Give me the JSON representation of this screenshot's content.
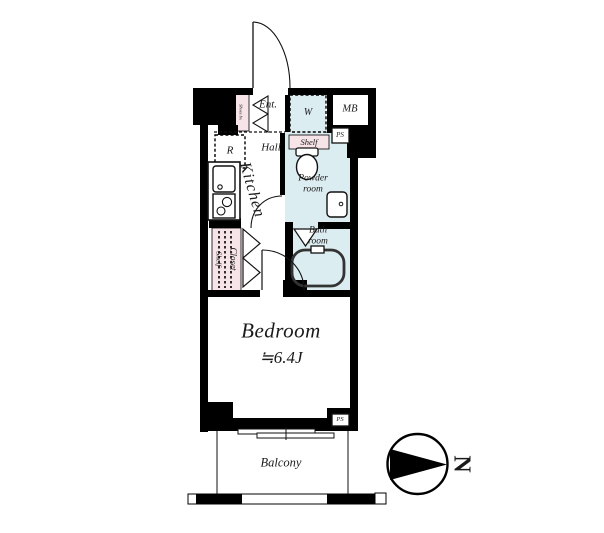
{
  "floorplan": {
    "rooms": {
      "entrance": "Ent.",
      "hall": "Hall",
      "kitchen": "Kitchen",
      "powder_room": "Powder room",
      "bath_room": "Bath room",
      "bedroom": "Bedroom",
      "bedroom_size": "≒6.4J",
      "balcony": "Balcony"
    },
    "fixtures": {
      "washer": "W",
      "meter_box": "MB",
      "pipe_space_upper": "PS",
      "pipe_space_lower": "PS",
      "refrigerator": "R",
      "shoes_box": "Shoes bx",
      "shelf_upper": "Shelf",
      "closet": "Closet",
      "closet_shelf": "Shelf"
    },
    "compass": {
      "north": "N"
    },
    "colors": {
      "wall": "#000000",
      "wet_area_fill": "#dcedf2",
      "storage_fill": "#f7e4e8"
    }
  }
}
